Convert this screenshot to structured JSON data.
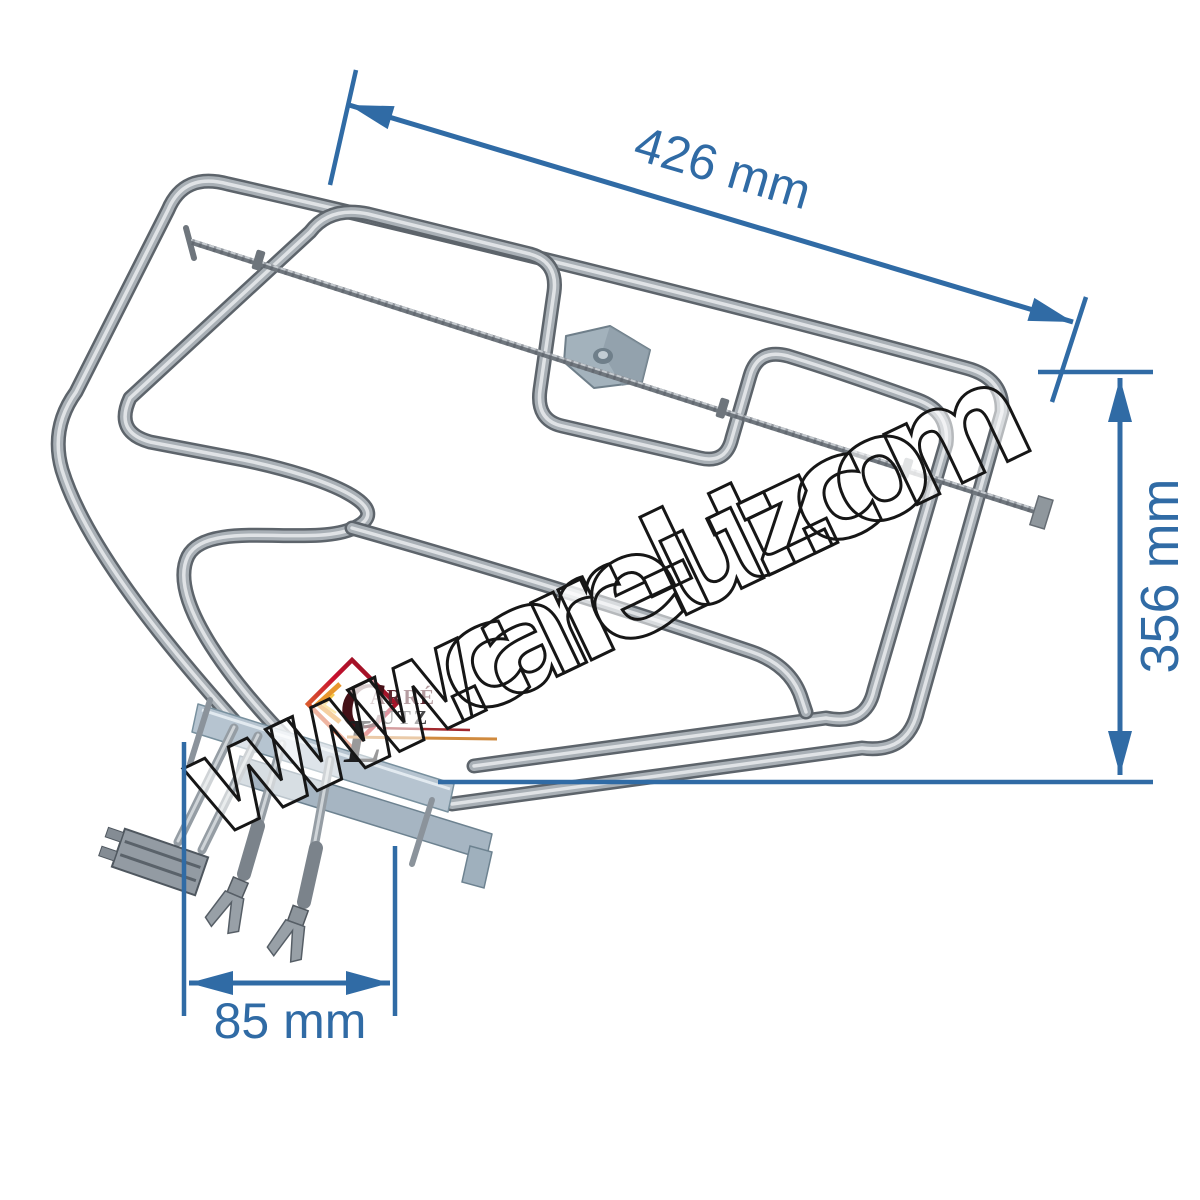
{
  "page": {
    "background": "#ffffff"
  },
  "annotations": {
    "accent_color": "#306ba5",
    "width_dim": {
      "label": "426 mm"
    },
    "height_dim": {
      "label": "356 mm"
    },
    "spacing_dim": {
      "label": "85 mm"
    }
  },
  "watermark": {
    "text": "www.carre-lutz.com"
  },
  "logo": {
    "word1_initial": "C",
    "word1_rest": "ARRÉ",
    "word2_initial": "L",
    "word2_rest": "UTZ"
  },
  "colors": {
    "tube": "#a9b0b6",
    "flange": "#b6c4d0",
    "logo_red": "#c8102e",
    "logo_orange": "#e8962e"
  }
}
